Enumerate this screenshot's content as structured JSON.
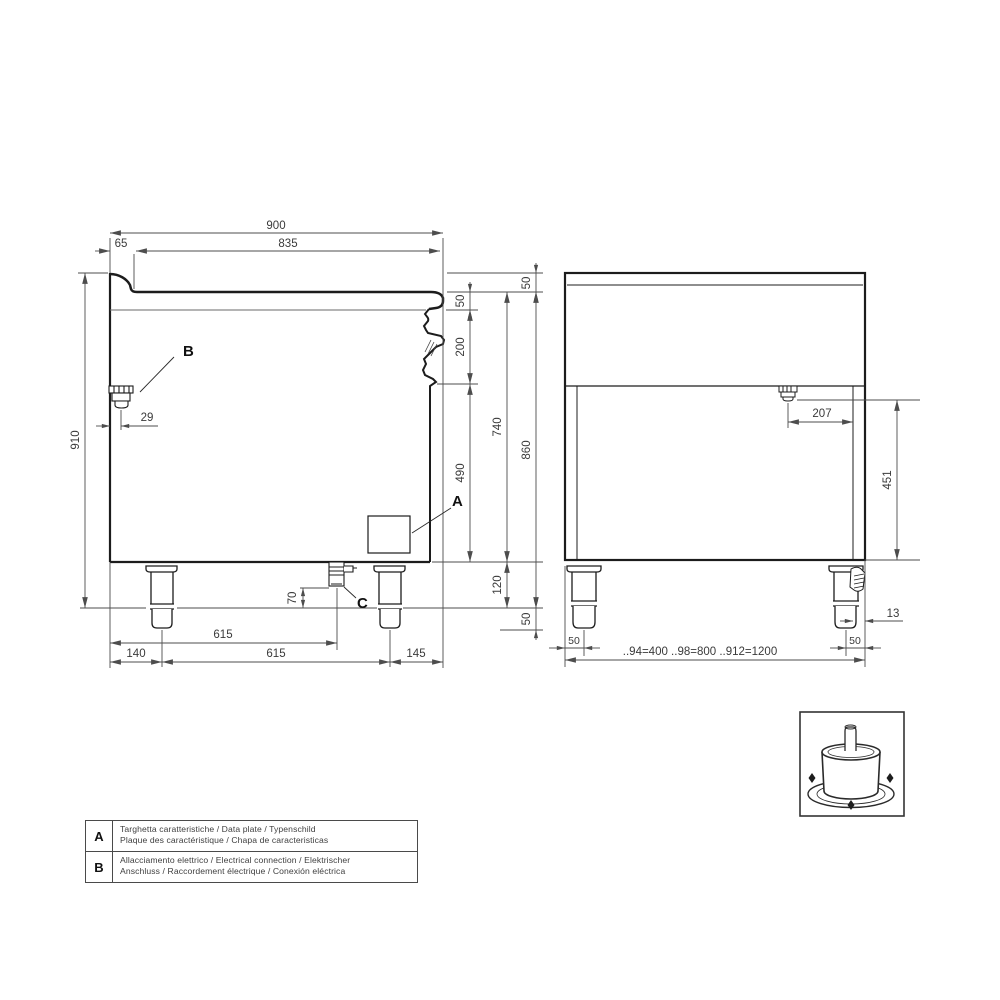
{
  "page": {
    "background": "#ffffff"
  },
  "colors": {
    "outline": "#1c1c1c",
    "dim_line": "#4d4d4d",
    "dim_text": "#3a3a3a"
  },
  "labels": {
    "a": "A",
    "b": "B",
    "c": "C"
  },
  "side_view": {
    "name": "side-section-view",
    "dims": {
      "overall_depth": "900",
      "rear_edge": "65",
      "worktop_depth": "835",
      "overall_height": "910",
      "rear_connector_offset": "29",
      "splash_height": "50",
      "top_edge_height": "50",
      "panel_height": "200",
      "front_height": "490",
      "body_height": "740",
      "plinth_height": "120",
      "worktop_height": "860",
      "foot_adjustment": "50",
      "drain_drop": "70",
      "drain_from_rear": "615",
      "rear_leg_offset": "140",
      "leg_spacing": "615",
      "front_leg_offset": "145"
    }
  },
  "front_view": {
    "name": "rear-elevation-view",
    "dims": {
      "connector_from_edge": "207",
      "connector_height": "451",
      "foot_edge_offset": "13",
      "left_leg_inset": "50",
      "right_leg_inset": "50",
      "model_widths": "..94=400 ..98=800 ..912=1200"
    }
  },
  "legend": {
    "rows": [
      {
        "key": "A",
        "line1": "Targhetta caratteristiche / Data plate / Typenschild",
        "line2": "Plaque des caractéristique / Chapa de caracteristicas"
      },
      {
        "key": "B",
        "line1": "Allacciamento elettrico / Electrical connection / Elektrischer",
        "line2": "Anschluss / Raccordement électrique / Conexión eléctrica"
      }
    ]
  }
}
